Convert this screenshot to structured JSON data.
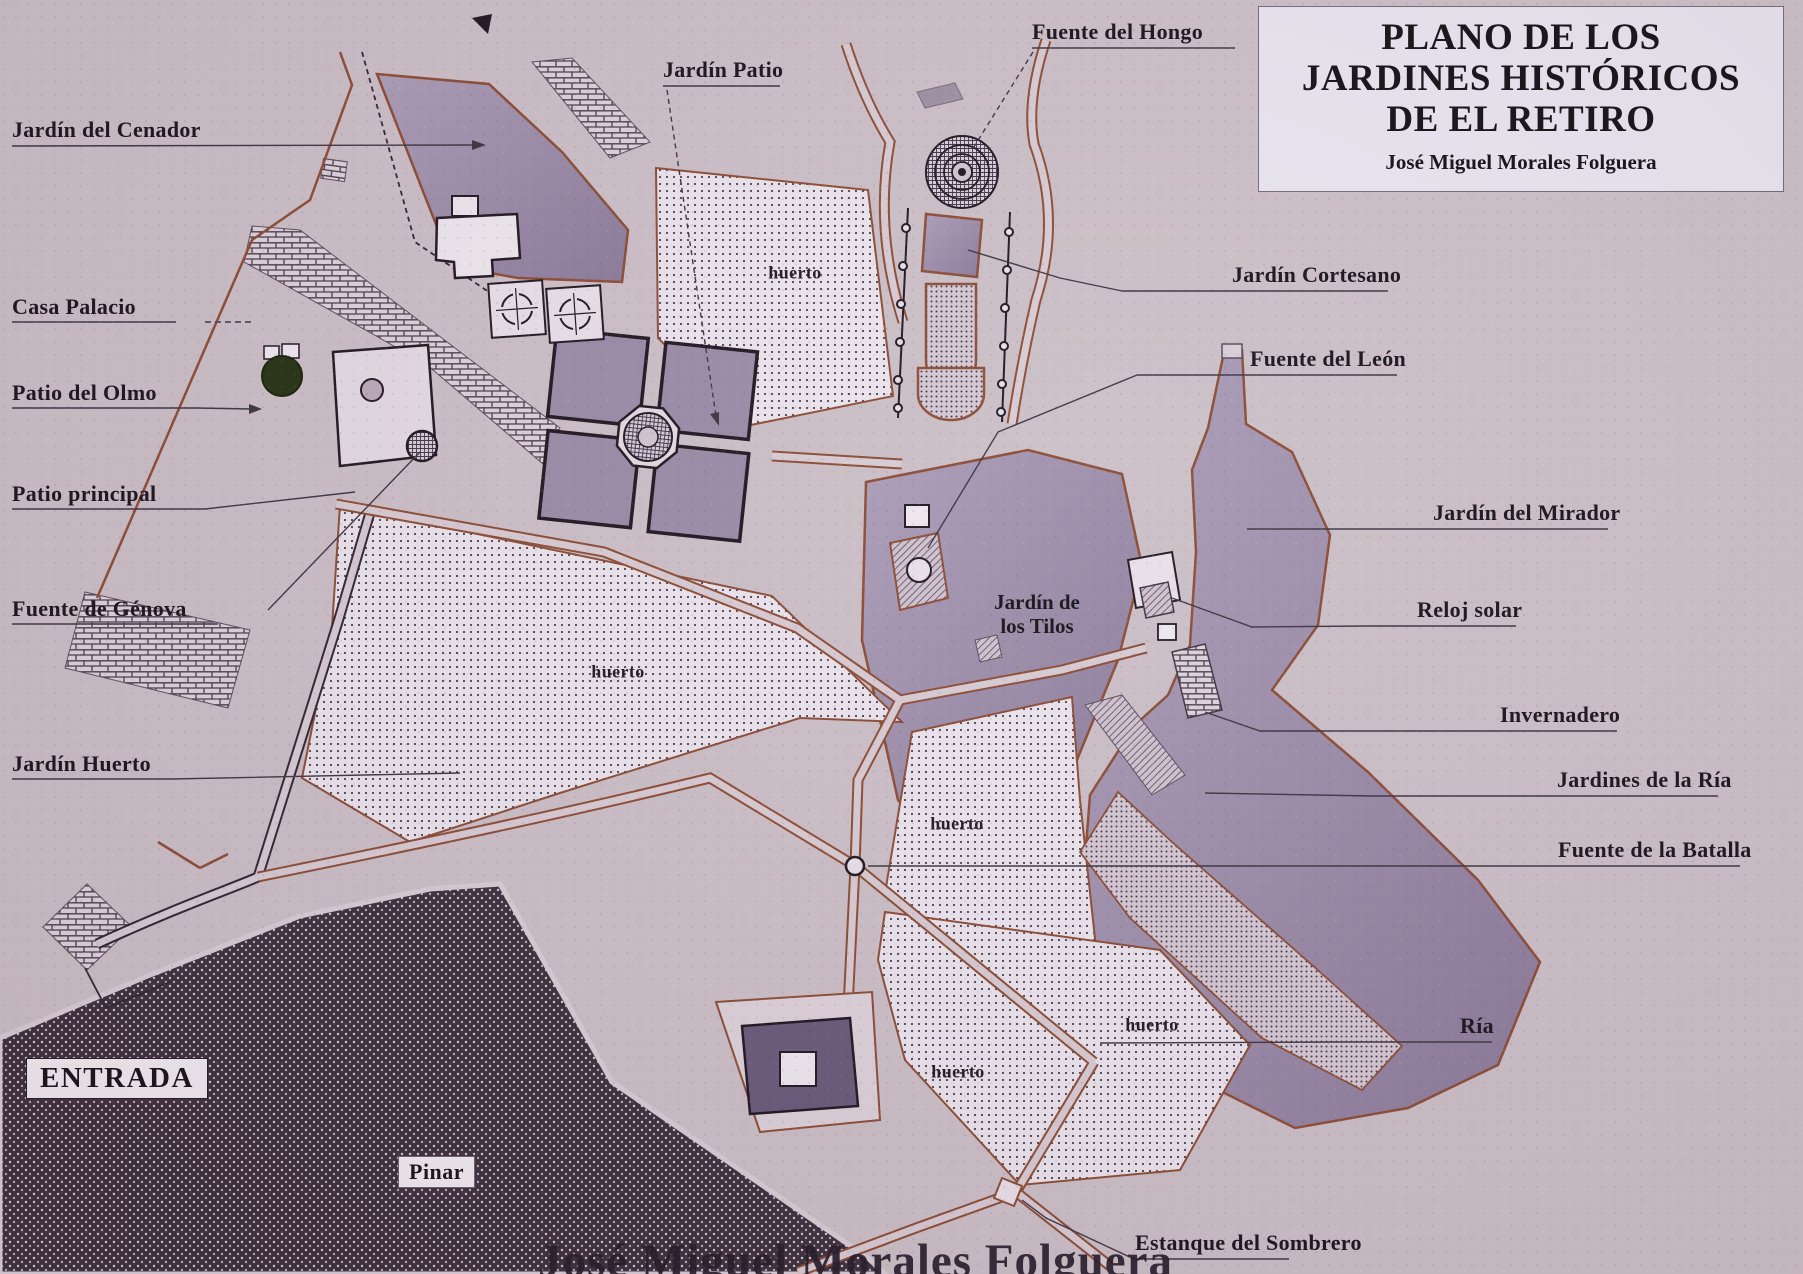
{
  "title_box": {
    "line1": "PLANO DE LOS",
    "line2": "JARDINES HISTÓRICOS",
    "line3": "DE EL RETIRO",
    "author": "José Miguel Morales Folguera"
  },
  "watermark": "José Miguel Morales Folguera",
  "labels": {
    "jardin_del_cenador": "Jardín del Cenador",
    "casa_palacio": "Casa Palacio",
    "patio_del_olmo": "Patio del Olmo",
    "patio_principal": "Patio principal",
    "fuente_de_genova": "Fuente de Génova",
    "jardin_huerto": "Jardín Huerto",
    "jardin_patio": "Jardín Patio",
    "fuente_del_hongo": "Fuente del Hongo",
    "jardin_cortesano": "Jardín Cortesano",
    "fuente_del_leon": "Fuente del León",
    "jardin_del_mirador": "Jardín del Mirador",
    "reloj_solar": "Reloj solar",
    "invernadero": "Invernadero",
    "jardines_de_la_ria": "Jardines de la Ría",
    "fuente_de_la_batalla": "Fuente de la Batalla",
    "ria": "Ría",
    "estanque_del_sombrero": "Estanque del Sombrero",
    "entrada": "ENTRADA",
    "pinar": "Pinar",
    "huerto": "huerto",
    "tilos_line1": "Jardín de",
    "tilos_line2": "los Tilos"
  },
  "colors": {
    "paper_background": "#cbbfc7",
    "garden_purple": "#9a8ba9",
    "path_brown": "#8a4a32",
    "pinar_dark": "#392c3a",
    "field_dotted": "#ebe5ee",
    "title_box_background": "#e9e5f0",
    "label_ink": "#171019"
  }
}
